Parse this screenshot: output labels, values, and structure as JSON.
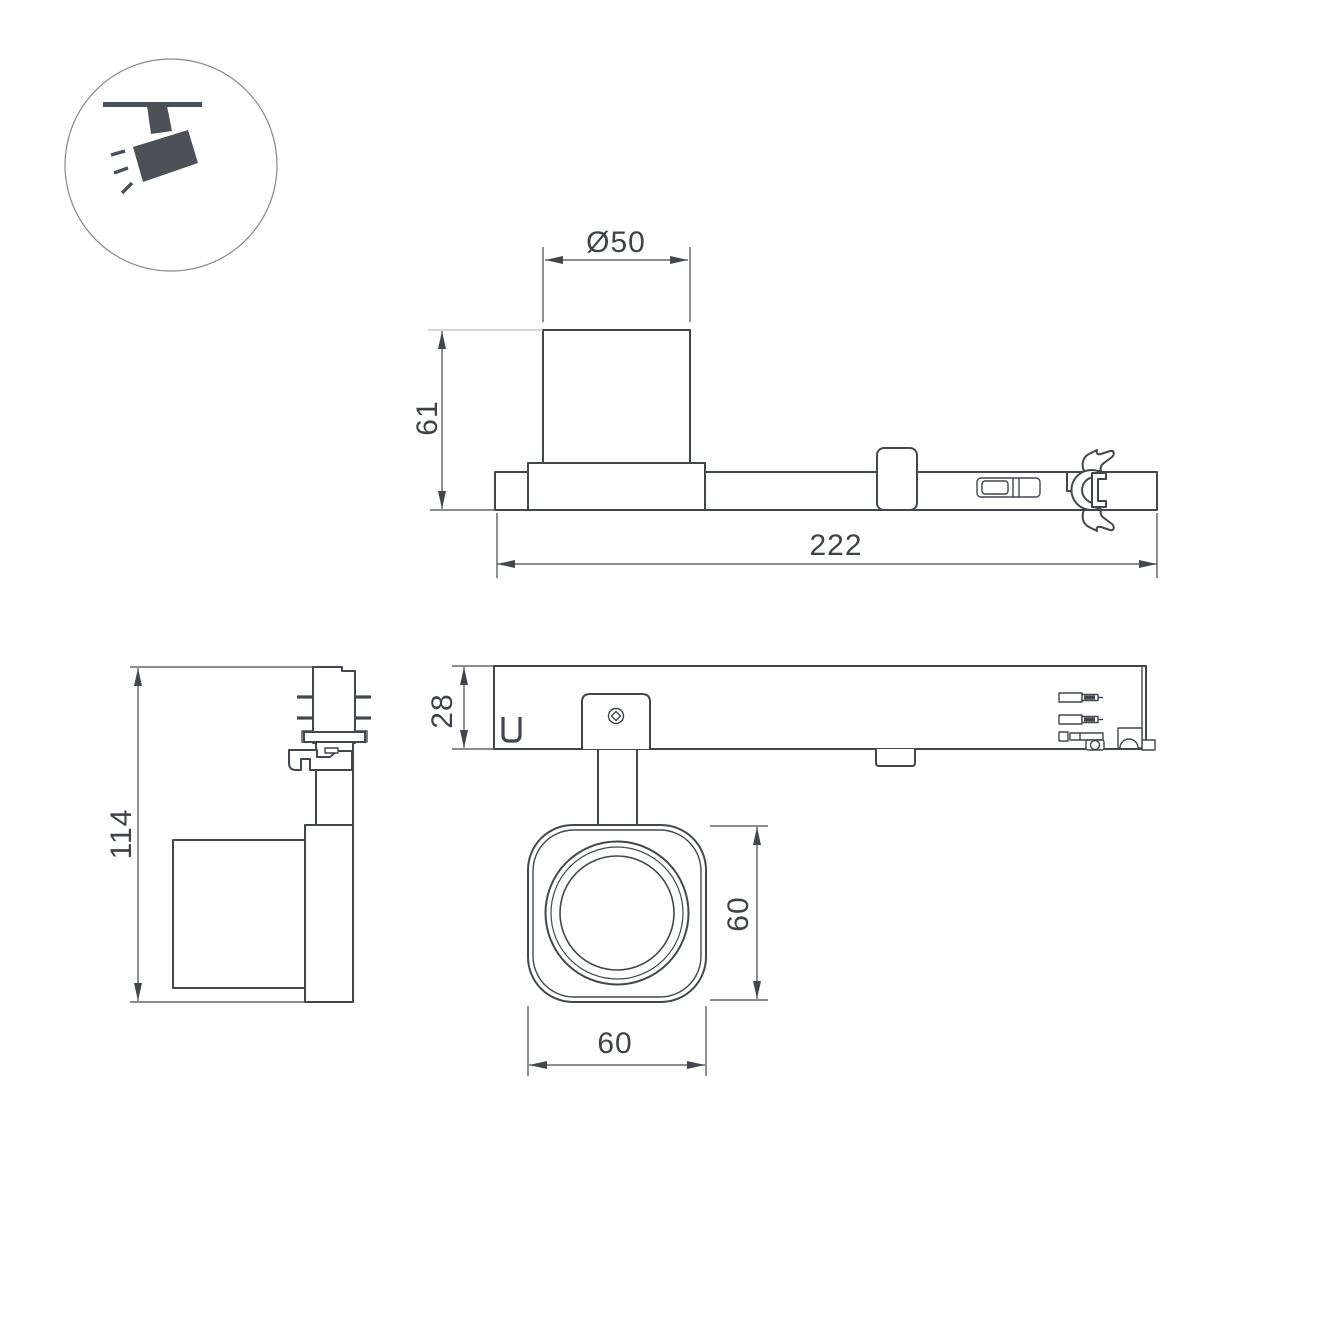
{
  "colors": {
    "line": "#43474c",
    "text": "#3f4347",
    "icon": "#4b5157",
    "light_ext": "#a9adb0",
    "background": "#ffffff"
  },
  "icon": {
    "name": "ceiling-track-spotlight",
    "description": "spotlight hanging from ceiling track inside circle"
  },
  "dims": {
    "top": {
      "diameter": "Ø50",
      "height": "61",
      "length": "222"
    },
    "side": {
      "height": "114"
    },
    "front": {
      "track_height": "28",
      "head_height": "60",
      "head_width": "60"
    }
  }
}
